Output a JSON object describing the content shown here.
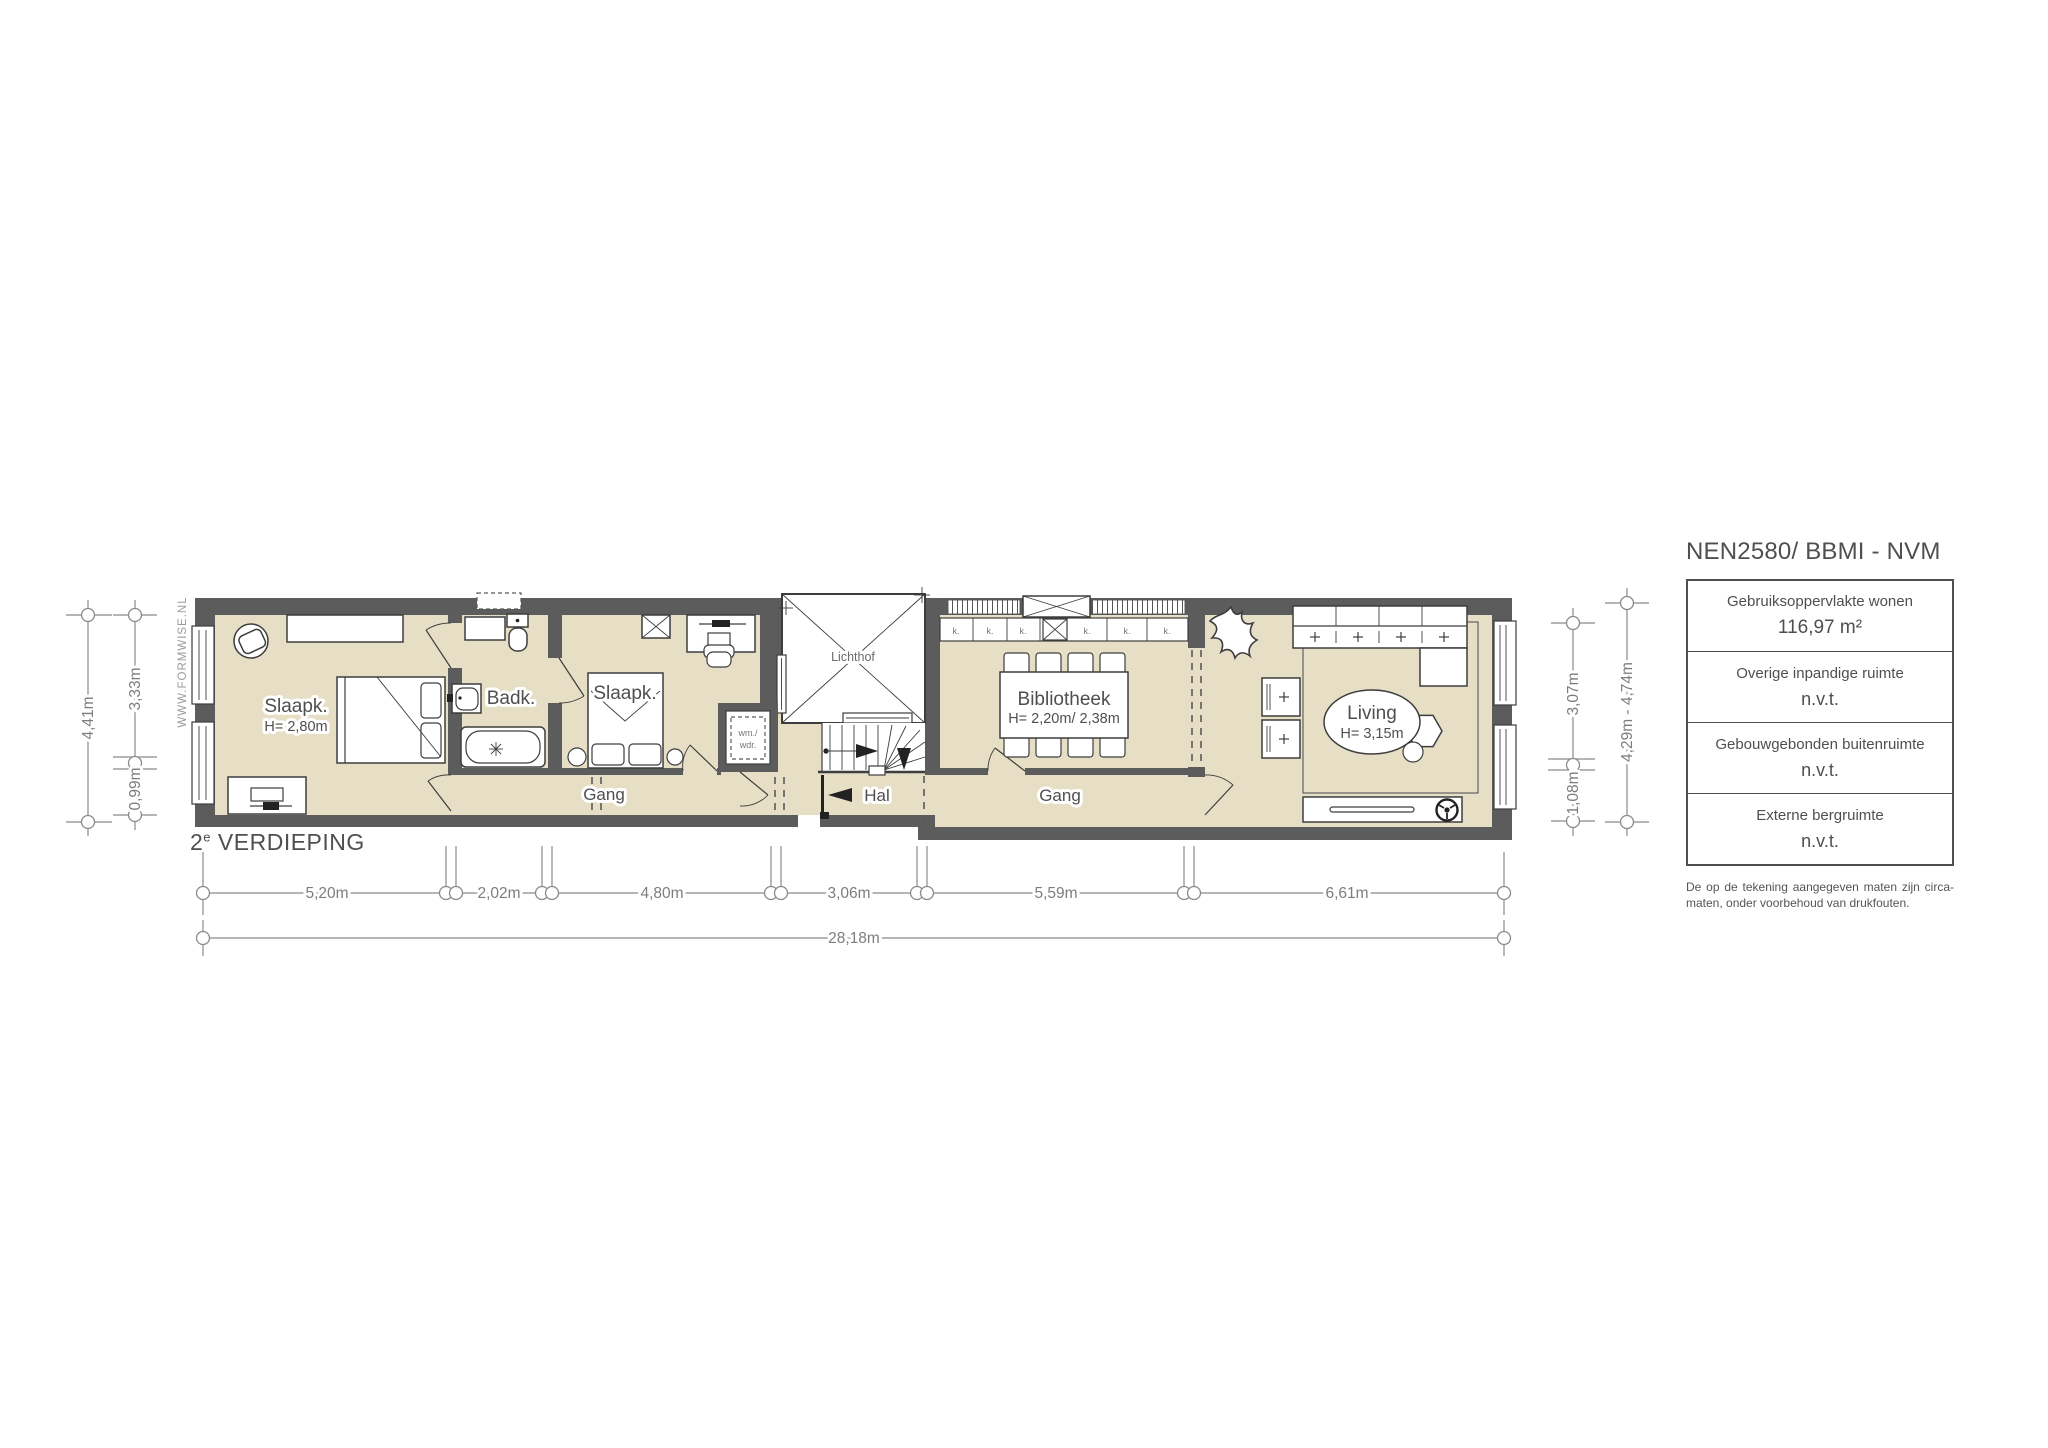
{
  "colors": {
    "wall": "#5c5c5c",
    "floor": "#e6dfc6",
    "stroke": "#3d3d3d",
    "dim": "#8a8a8a",
    "text": "#4f4f4f"
  },
  "watermark": "WWW.FORMWISE.NL",
  "floor_title": {
    "number": "2",
    "sup": "e",
    "text": " VERDIEPING"
  },
  "rooms": {
    "slaapk1": {
      "label": "Slaapk.",
      "height": "H= 2,80m"
    },
    "badk": {
      "label": "Badk."
    },
    "slaapk2": {
      "label": "Slaapk."
    },
    "gang_left": {
      "label": "Gang"
    },
    "lichthof": {
      "label": "Lichthof"
    },
    "hal": {
      "label": "Hal"
    },
    "wasmachine": {
      "line1": "wm./",
      "line2": "wdr."
    },
    "bibliotheek": {
      "label": "Bibliotheek",
      "height": "H= 2,20m/ 2,38m"
    },
    "gang_right": {
      "label": "Gang"
    },
    "living": {
      "label": "Living",
      "height": "H= 3,15m"
    },
    "closet_cell": "k."
  },
  "dimensions": {
    "bottom": [
      "5,20m",
      "2,02m",
      "4,80m",
      "3,06m",
      "5,59m",
      "6,61m"
    ],
    "total": "28,18m",
    "left_outer": "4,41m",
    "left_inner_top": "3,33m",
    "left_inner_bottom": "0,99m",
    "right_inner_top": "3,07m",
    "right_inner_bottom": "1,08m",
    "right_outer": "4,29m - 4,74m"
  },
  "legend": {
    "title": "NEN2580/ BBMI - NVM",
    "rows": [
      {
        "label": "Gebruiksoppervlakte wonen",
        "value": "116,97 m²"
      },
      {
        "label": "Overige inpandige ruimte",
        "value": "n.v.t."
      },
      {
        "label": "Gebouwgebonden buitenruimte",
        "value": "n.v.t."
      },
      {
        "label": "Externe bergruimte",
        "value": "n.v.t."
      }
    ],
    "disclaimer": "De op de tekening aangegeven maten zijn circa-maten, onder voorbehoud van drukfouten."
  }
}
